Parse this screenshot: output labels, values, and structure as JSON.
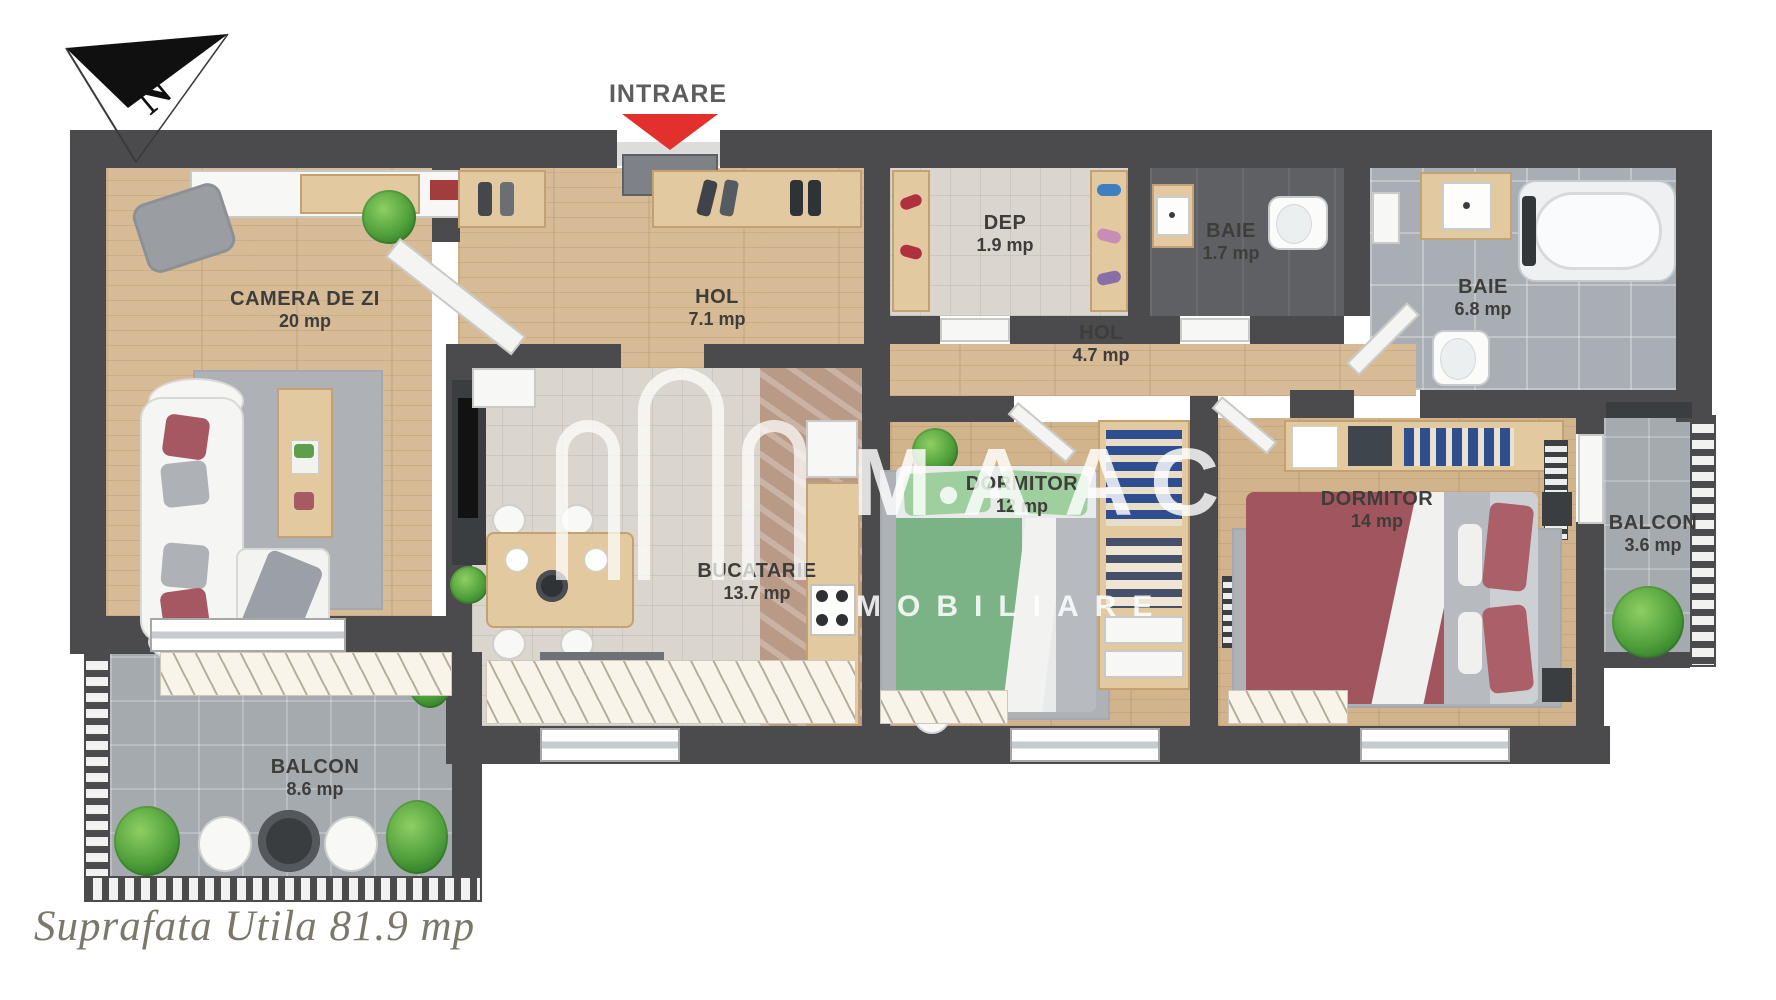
{
  "compass": {
    "north": "N"
  },
  "entrance": {
    "label": "INTRARE"
  },
  "rooms": {
    "living": {
      "name": "CAMERA DE ZI",
      "area": "20 mp"
    },
    "hall_entry": {
      "name": "HOL",
      "area": "7.1 mp"
    },
    "storage": {
      "name": "DEP",
      "area": "1.9 mp"
    },
    "bath_small": {
      "name": "BAIE",
      "area": "1.7 mp"
    },
    "bath_large": {
      "name": "BAIE",
      "area": "6.8 mp"
    },
    "hall_night": {
      "name": "HOL",
      "area": "4.7 mp"
    },
    "kitchen": {
      "name": "BUCATARIE",
      "area": "13.7 mp"
    },
    "bedroom_12": {
      "name": "DORMITOR",
      "area": "12 mp"
    },
    "bedroom_14": {
      "name": "DORMITOR",
      "area": "14 mp"
    },
    "balcony_right": {
      "name": "BALCON",
      "area": "3.6 mp"
    },
    "balcony_lower": {
      "name": "BALCON",
      "area": "8.6 mp"
    }
  },
  "watermark": {
    "brand_letters": [
      "M",
      "•",
      "A",
      "A",
      "C"
    ],
    "sub": "MOBILIARE"
  },
  "footer": {
    "total_area": "Suprafata Utila 81.9 mp"
  },
  "colors": {
    "wall": "#4b4b4d",
    "arrow_red": "#e3302c",
    "wood_floor": "#d6bb96",
    "tile_gray": "#a9aeb4",
    "tile_dark": "#5e6064",
    "balcony_stone": "#a5aaaf",
    "bed_green": "#7cb386",
    "bed_red": "#a1565f"
  }
}
